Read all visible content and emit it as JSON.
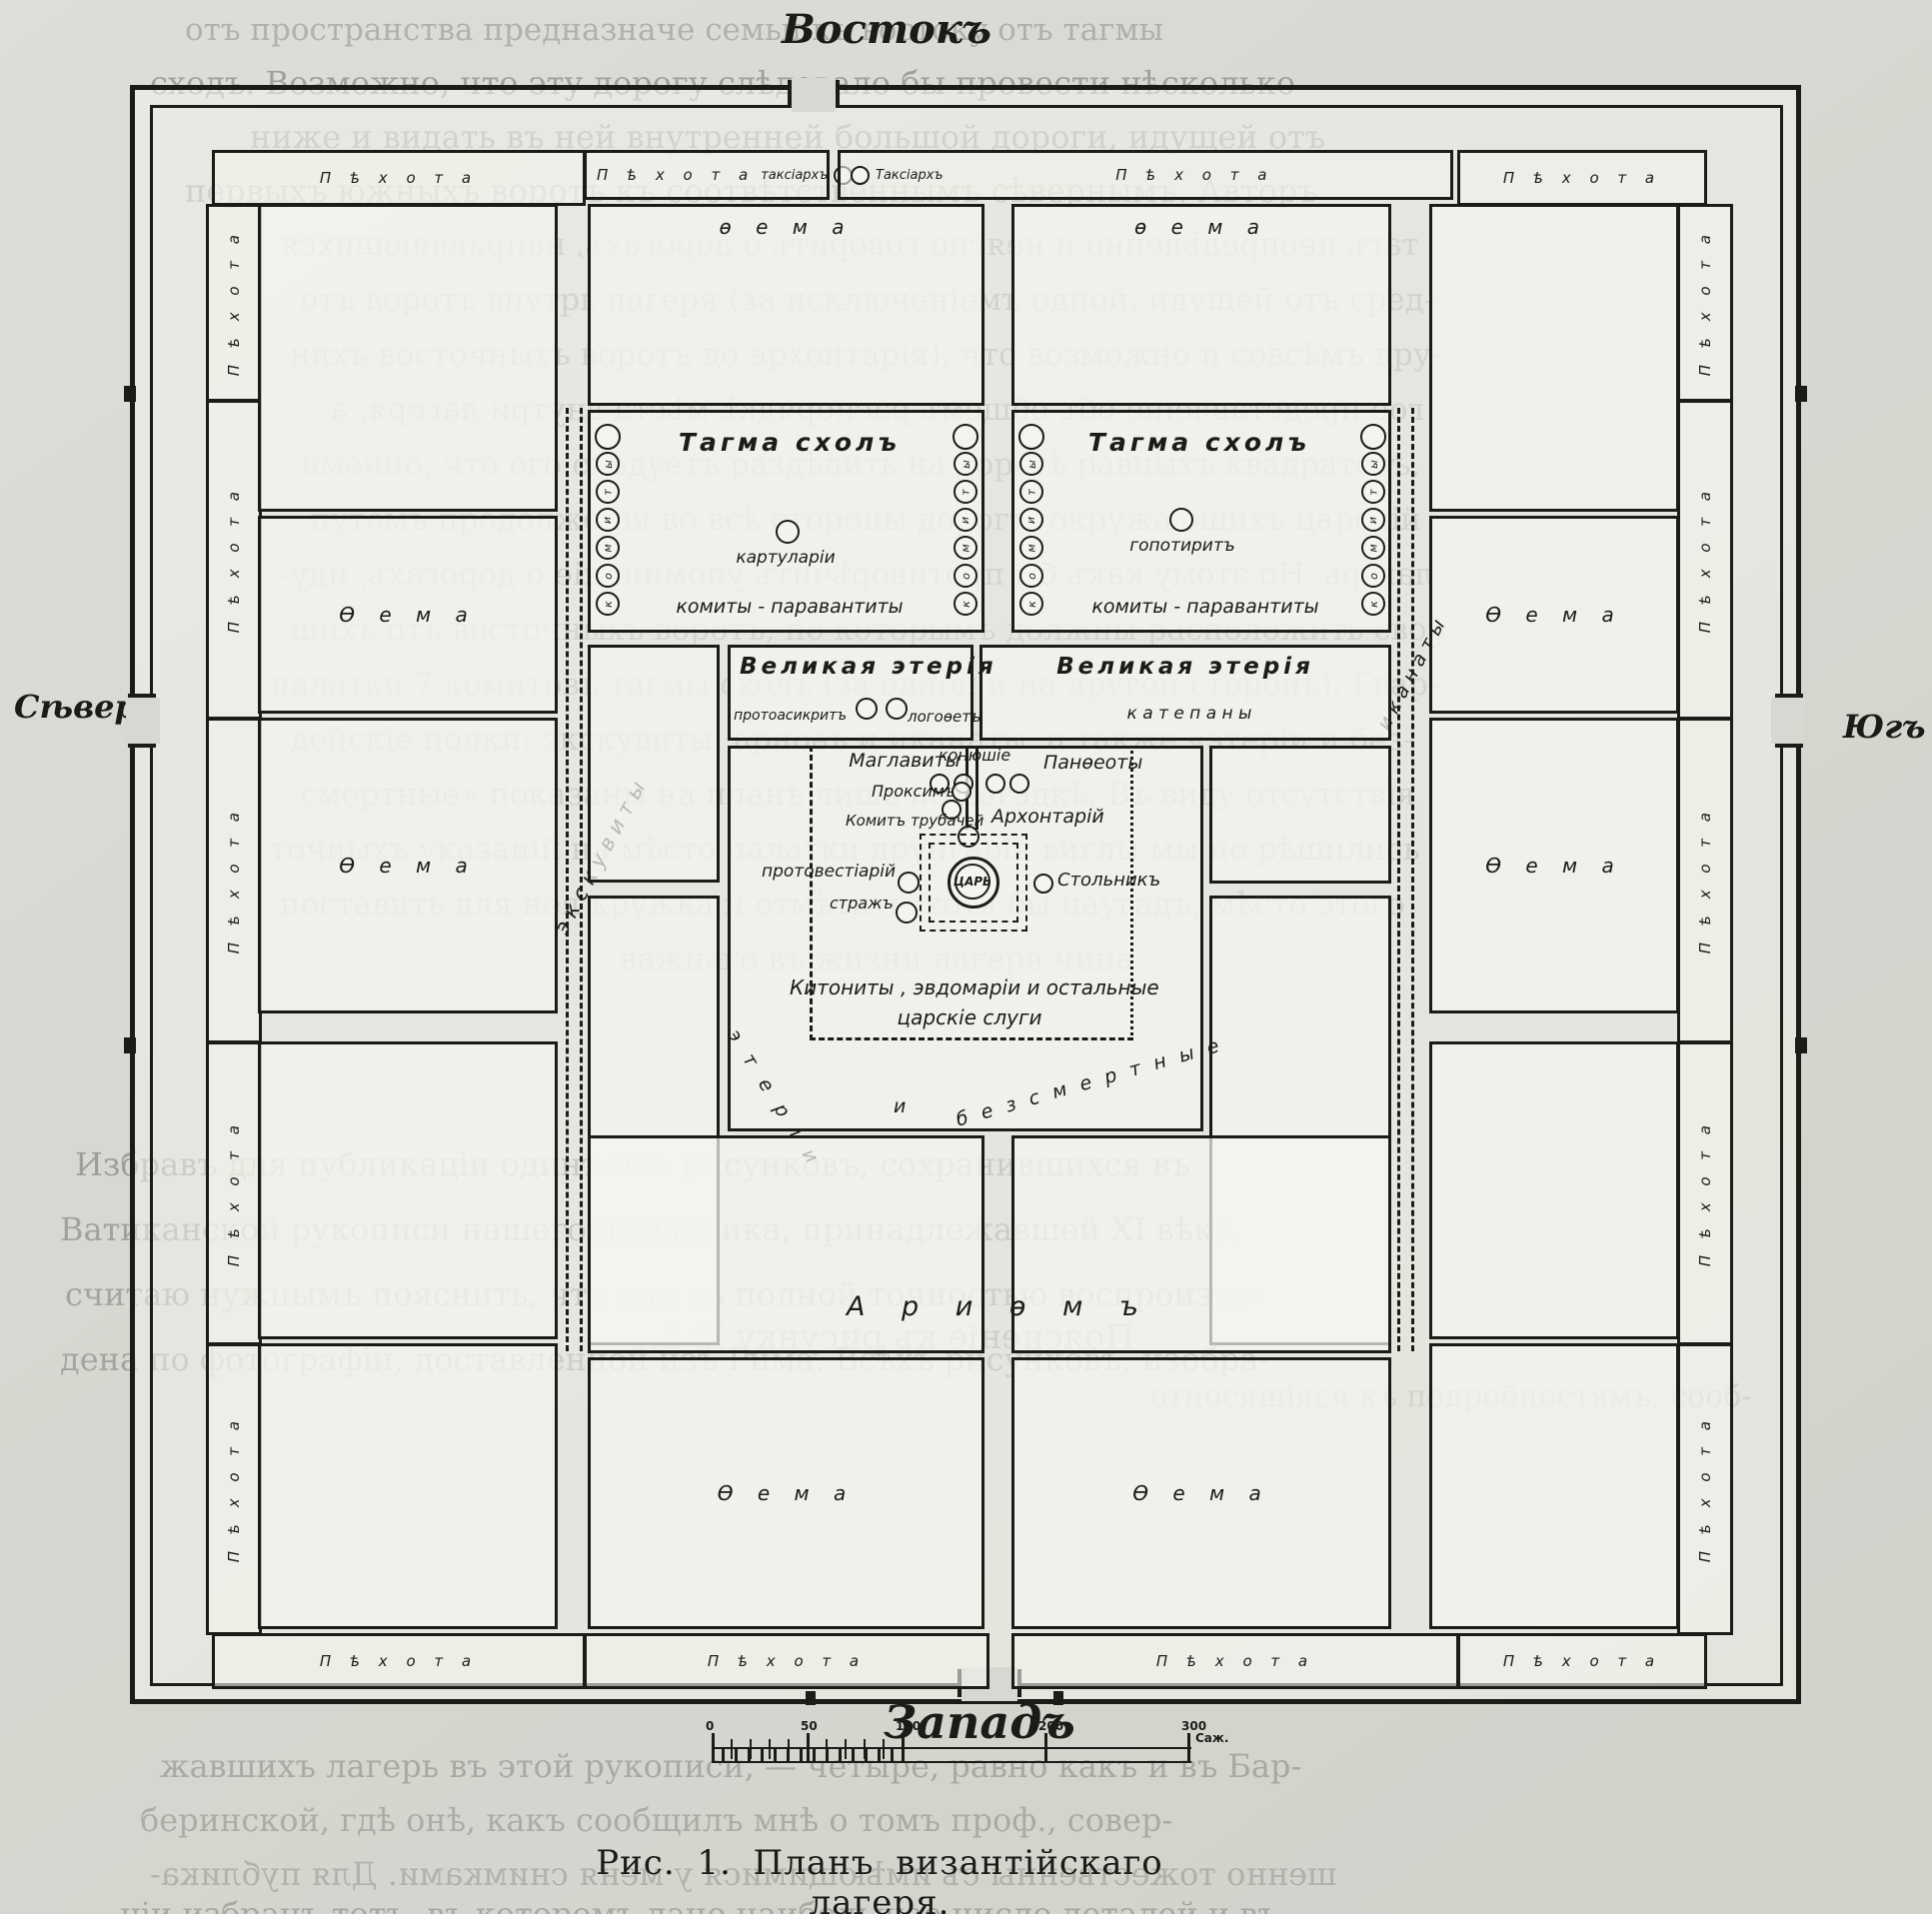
{
  "figure": {
    "caption": "Рис. 1.  Планъ византійскаго лагеря."
  },
  "compass": {
    "east": "Востокъ",
    "west": "Западъ",
    "north": "Сѣверъ",
    "south": "Югъ"
  },
  "scale": {
    "ticks": [
      "0",
      "50",
      "100",
      "200",
      "300"
    ],
    "unit": "Саж."
  },
  "perimeter": {
    "infantry": "П ѣ х о т а",
    "taxiarch_left": "таксіархъ",
    "taxiarch_right": "Таксіархъ"
  },
  "camp": {
    "thema": "Ѳ е м а",
    "thema_lower": "ѳ е м а",
    "tagma_schol": "Тагма схолъ",
    "chartularii": "картуларіи",
    "gopotirit": "гопотиритъ",
    "comites": "комиты - паравантиты",
    "circle_letters": [
      "ы",
      "т",
      "и",
      "м",
      "о",
      "к"
    ],
    "great_heteria": "Великая этерія",
    "protoasecretis": "протоасикритъ",
    "logothete": "логоѳетъ",
    "katepans": "к а т е п а н ы",
    "maglavites": "Маглавиты",
    "proxim": "Проксимъ",
    "comit_trumpeters": "Комитъ трубачей",
    "protovestiarius": "протовестіарій",
    "guard": "стражъ",
    "grooms": "конюшіе",
    "pantheoty": "Панѳеоты",
    "archontarius": "Архонтарій",
    "tsar": "ЦАРЬ",
    "stolnik": "Стольникъ",
    "kitonites_1": "Китониты , эвдомаріи и остальные",
    "kitonites_2": "царскіе слуги",
    "heteria_1": "э т е р і и",
    "heteria_2": "и",
    "heteria_3": "б е з с м е р т н ы е",
    "excubitors": "э к с к у в и т ы",
    "hikanatoi": "и к а н а т ы",
    "arithmos": "А р и ѳ м ъ"
  },
  "bleedthrough": [
    "отъ пространства предназначе      семьи къ востоку отъ тагмы",
    "сходъ. Возможно, что эту дорогу слѣдовало бы провести нѣсколько",
    "ниже и видать въ ней внутренней большой дороги, идущей отъ",
    "первыхъ южныхъ воротъ къ соотвѣтственнымъ сѣвернымъ. Авторъ",
    "тагъ неопредѣленно и неясно говоритъ о дорогахъ, направляющихся",
    "отъ воротъ внутрь лагеря (за исключеніемъ одной, идущей отъ сред-",
    "нихъ восточныхъ воротъ до архонтарія), что возможно и совсѣмъ дру-",
    "гое представленіе объ общемъ распорядкѣ мѣста внутри лагеря, а",
    "именно, что его слѣдуетъ раздѣлить на дорогѣ равныхъ квадратовъ,",
    "путемъ продолженія во всѣ стороны дорогъ, окружающихъ царскій",
    "лагерь. Но этому какъ бы противорѣчитъ упоминаніе о дорогахъ, иду-",
    "щихъ отъ восточныхъ воротъ, по которымъ должны расположить свои",
    "палатки 7 комитовъ тагмы схолъ (за одной и на другой сторонѣ). Гвар-",
    "дейскіе полки: экскувиты, арноѳъ и иканаты, а также «этеріи и без-",
    "смертные» показаны на планѣ лишь по догадкѣ. Въ виду отсутствія",
    "точныхъ указаній на мѣсто палатки друнгарія виглы мы не рѣшились",
    "поставить для нея кружка и отмѣтить, хотя бы наугадъ, мѣсто этого",
    "важнаго въ жизни лагеря чина.",
    "Поясненіе къ рисунку № 2.",
    "относящіяся къ подробностямъ, сооб-",
    "Избравъ для публикаціи одинъ изъ рисунковъ, сохранившихся въ",
    "Ватиканской рукописи нашего памятника, принадлежавшей XI вѣку,",
    "считаю нужнымъ пояснить, что она съ полной точностью воспроизве-",
    "дена по фотографіи, доставленной изъ Рима. Всѣхъ рисунковъ, изобра-",
    "жавшихъ лагерь въ этой рукописи, — четыре, равно какъ и въ Бар-",
    "беринской, гдѣ онѣ, какъ сообщилъ мнѣ о томъ проф., совер-",
    "шенно тожественны съ имѣющимися у меня снимками. Для публика-",
    "ціи избранъ тотъ, въ которомъ дано наибольшее число деталей и въ"
  ],
  "colors": {
    "ink": "#1c1b18",
    "paper": "#d8d7d1"
  }
}
